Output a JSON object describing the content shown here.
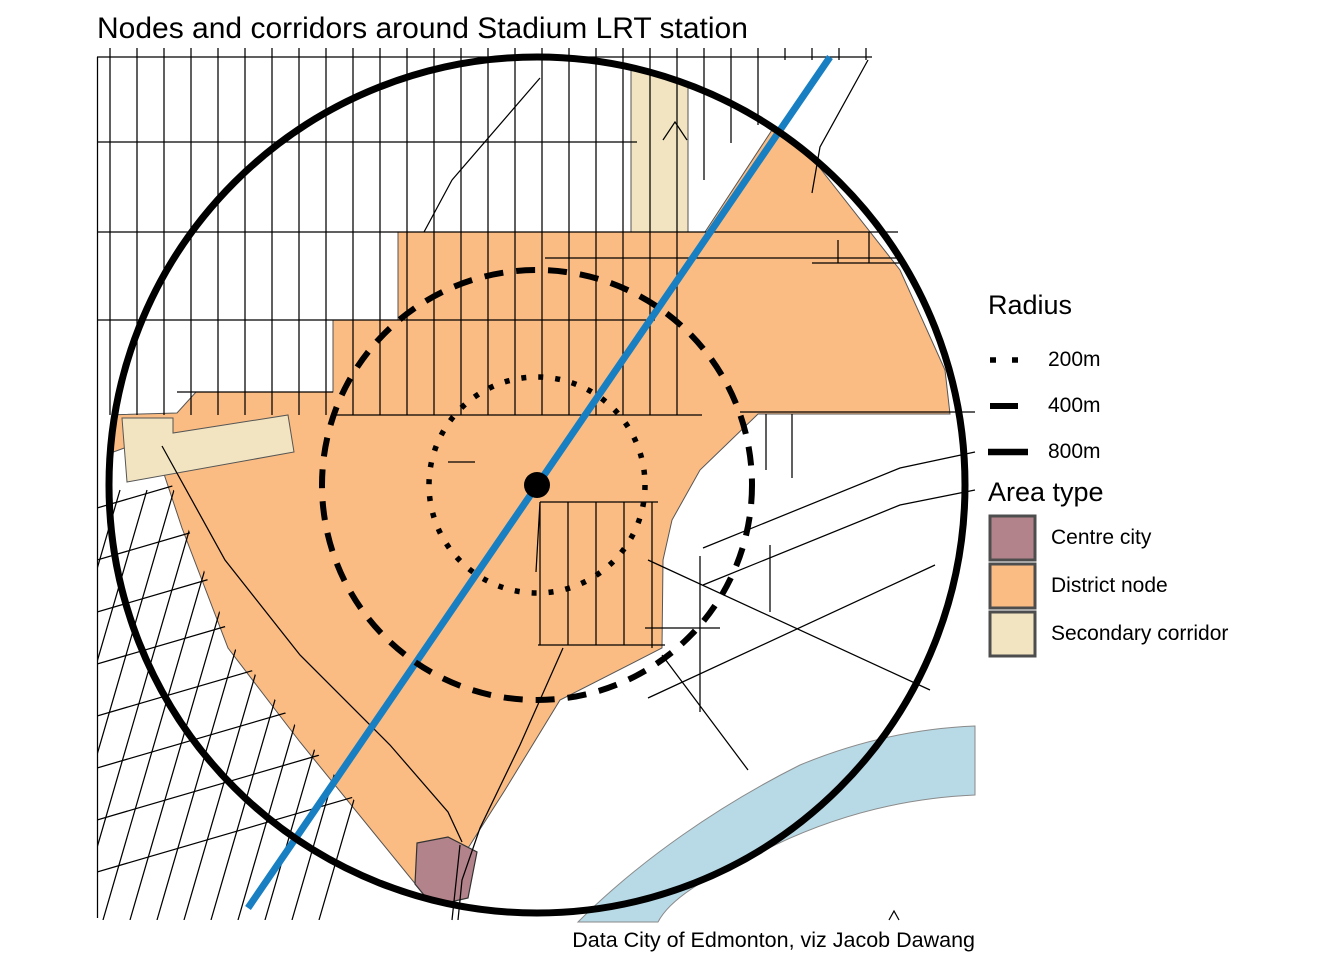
{
  "title": "Nodes and corridors around Stadium LRT station",
  "caption": "Data City of Edmonton, viz Jacob Dawang",
  "legend": {
    "radius": {
      "heading": "Radius",
      "items": [
        {
          "label": "200m",
          "pattern": "dotted"
        },
        {
          "label": "400m",
          "pattern": "dashed"
        },
        {
          "label": "800m",
          "pattern": "solid"
        }
      ]
    },
    "area_type": {
      "heading": "Area type",
      "items": [
        {
          "label": "Centre city",
          "color": "#B2838A"
        },
        {
          "label": "District node",
          "color": "#FBBC83"
        },
        {
          "label": "Secondary corridor",
          "color": "#F2E4C1"
        }
      ]
    }
  },
  "map": {
    "colors": {
      "centre_city": "#B2838A",
      "district_node": "#FBBC83",
      "secondary_corridor": "#F2E4C1",
      "river": "#B7DAE6",
      "lrt_line": "#187FC2",
      "ring": "#000000"
    },
    "rings": [
      {
        "label": "200m",
        "radius_px": 108,
        "pattern": "dotted"
      },
      {
        "label": "400m",
        "radius_px": 215,
        "pattern": "dashed"
      },
      {
        "label": "800m",
        "radius_px": 428,
        "pattern": "solid"
      }
    ],
    "station_dot_radius_px": 13
  }
}
